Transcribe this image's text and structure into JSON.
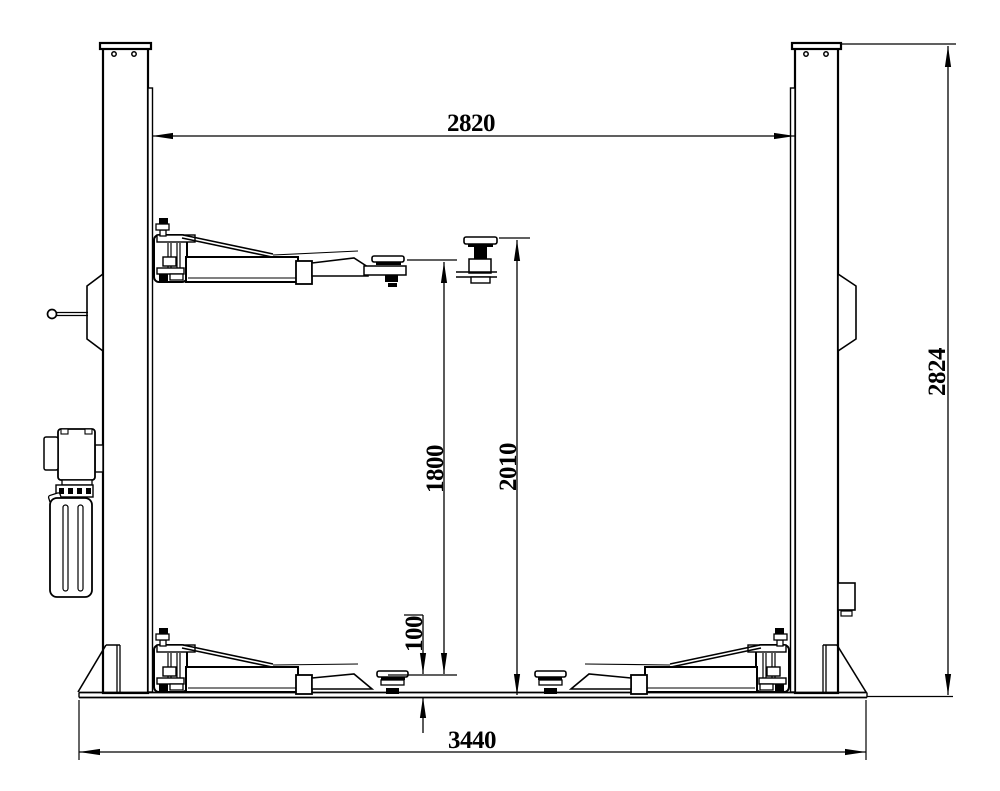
{
  "drawing": {
    "background_color": "#ffffff",
    "line_color": "#000000",
    "view": "two-post-vehicle-lift-front-elevation",
    "dimensions": {
      "distance_between_posts": "2820",
      "overall_height": "2824",
      "max_lifting_height": "1800",
      "height_to_adapter_top": "2010",
      "min_pad_height": "100",
      "overall_width": "3440"
    }
  }
}
